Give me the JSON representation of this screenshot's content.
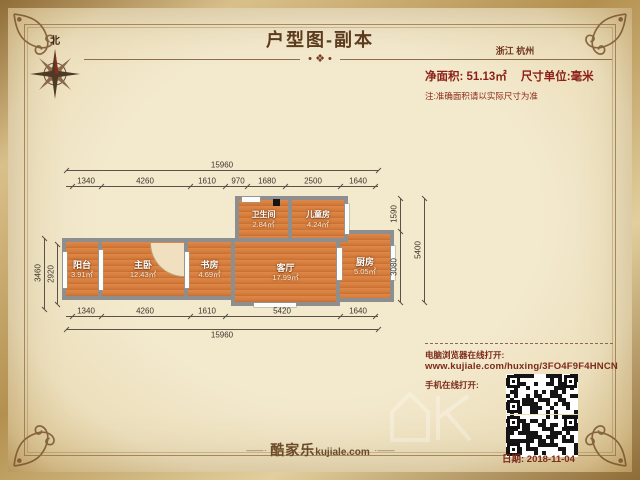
{
  "header": {
    "title": "户型图-副本",
    "location": "浙江 杭州",
    "net_area": "净面积: 51.13㎡",
    "unit": "尺寸单位:毫米",
    "note": "注:准确面积请以实际尺寸为准",
    "compass_north": "北",
    "divider_ornament": "• ❖ •"
  },
  "plan": {
    "rooms": {
      "balcony": {
        "label": "阳台",
        "area": "3.91㎡"
      },
      "master": {
        "label": "主卧",
        "area": "12.43㎡"
      },
      "study": {
        "label": "书房",
        "area": "4.69㎡"
      },
      "living": {
        "label": "客厅",
        "area": "17.99㎡"
      },
      "kitchen": {
        "label": "厨房",
        "area": "5.05㎡"
      },
      "bathroom": {
        "label": "卫生间",
        "area": "2.84㎡"
      },
      "kids": {
        "label": "儿童房",
        "area": "4.24㎡"
      }
    },
    "dims": {
      "top_total": "15960",
      "top_segments": [
        "1340",
        "4260",
        "1610",
        "970",
        "1680",
        "2500",
        "1640"
      ],
      "bottom_segments": [
        "1340",
        "4260",
        "1610",
        "5420",
        "1640"
      ],
      "bottom_total": "15960",
      "left_outer": "3460",
      "left_inner": "2920",
      "right_inner_top": "1590",
      "right_inner_bottom": "3080",
      "right_outer": "5400"
    }
  },
  "footer": {
    "pc_open_label": "电脑浏览器在线打开:",
    "url": "www.kujiale.com/huxing/3FO4F9F4HNCN",
    "mobile_open_label": "手机在线打开:",
    "date": "日期: 2018-11-04",
    "brand": "酷家乐",
    "brand_domain": "kujiale.com",
    "brand_ornament_left": "—— ·",
    "brand_ornament_right": "· ——"
  },
  "colors": {
    "accent_red": "#8b1f16",
    "wood_floor": "#d47b3a",
    "wall_gray": "#8e8e8e",
    "parchment": "#f3e9cd",
    "frame_gold": "#b3904f",
    "text_brown": "#5c3a1e"
  }
}
